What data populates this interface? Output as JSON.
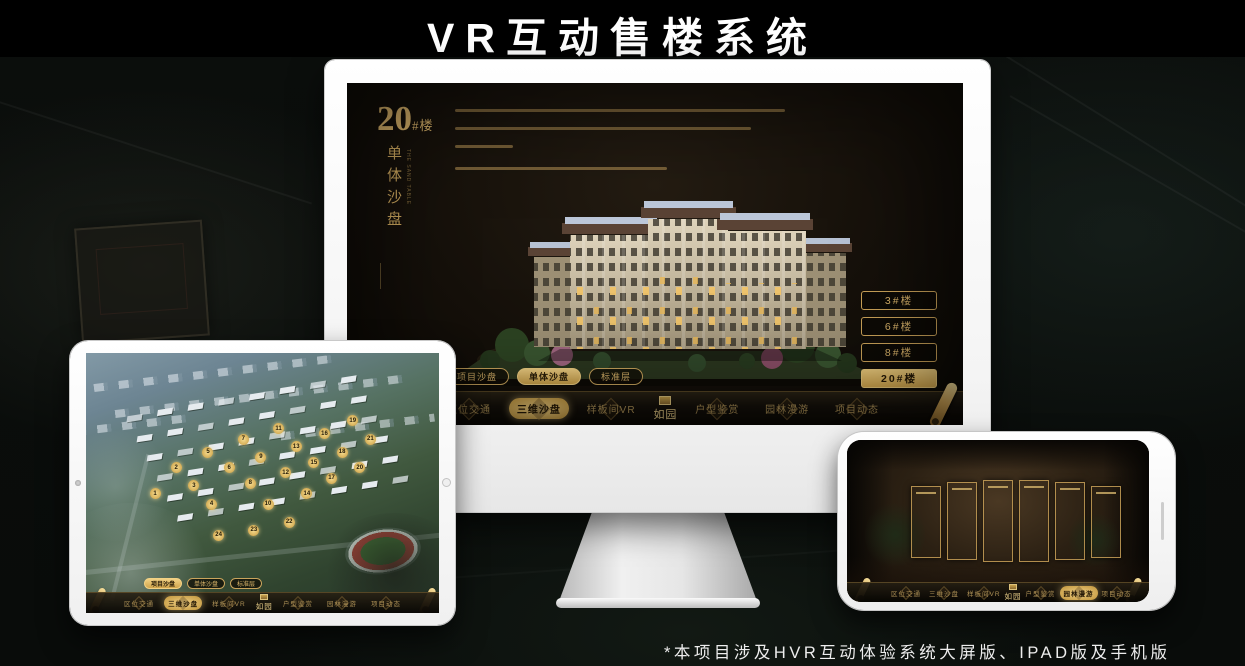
{
  "page": {
    "title": "VR互动售楼系统",
    "footnote": "*本项目涉及HVR互动体验系统大屏版、IPAD版及手机版"
  },
  "colors": {
    "accent_gold": "#d3ac5f",
    "gold_bright": "#f0d084",
    "screen_dark": "#15100a",
    "selected_text": "#241806",
    "title_text": "#ffffff"
  },
  "monitor_app": {
    "unit_label": {
      "number": "20",
      "suffix": "#楼",
      "subtitle": "单体沙盘",
      "subtitle_en": "THE SAND TABLE"
    },
    "unit_buttons": [
      {
        "label": "3#楼",
        "selected": false
      },
      {
        "label": "6#楼",
        "selected": false
      },
      {
        "label": "8#楼",
        "selected": false
      },
      {
        "label": "20#楼",
        "selected": true
      }
    ],
    "view_tabs": [
      {
        "label": "项目沙盘",
        "selected": false
      },
      {
        "label": "单体沙盘",
        "selected": true
      },
      {
        "label": "标准层",
        "selected": false
      }
    ],
    "nav": {
      "logo": "如园",
      "items": [
        {
          "label": "区位交通",
          "selected": false
        },
        {
          "label": "三维沙盘",
          "selected": true
        },
        {
          "label": "样板间VR",
          "selected": false
        },
        {
          "label": "户型鉴赏",
          "selected": false
        },
        {
          "label": "园林漫游",
          "selected": false
        },
        {
          "label": "项目动态",
          "selected": false
        }
      ]
    }
  },
  "tablet_app": {
    "view_tabs": [
      {
        "label": "项目沙盘",
        "selected": true
      },
      {
        "label": "单体沙盘",
        "selected": false
      },
      {
        "label": "标准层",
        "selected": false
      }
    ],
    "nav": {
      "logo": "如园",
      "items": [
        {
          "label": "区位交通",
          "selected": false
        },
        {
          "label": "三维沙盘",
          "selected": true
        },
        {
          "label": "样板间VR",
          "selected": false
        },
        {
          "label": "户型鉴赏",
          "selected": false
        },
        {
          "label": "园林漫游",
          "selected": false
        },
        {
          "label": "项目动态",
          "selected": false
        }
      ]
    },
    "markers": [
      {
        "n": "1",
        "x": 18,
        "y": 52
      },
      {
        "n": "2",
        "x": 24,
        "y": 42
      },
      {
        "n": "3",
        "x": 29,
        "y": 49
      },
      {
        "n": "4",
        "x": 34,
        "y": 56
      },
      {
        "n": "5",
        "x": 33,
        "y": 36
      },
      {
        "n": "6",
        "x": 39,
        "y": 42
      },
      {
        "n": "7",
        "x": 43,
        "y": 31
      },
      {
        "n": "8",
        "x": 45,
        "y": 48
      },
      {
        "n": "9",
        "x": 48,
        "y": 38
      },
      {
        "n": "10",
        "x": 50,
        "y": 56
      },
      {
        "n": "11",
        "x": 53,
        "y": 27
      },
      {
        "n": "12",
        "x": 55,
        "y": 44
      },
      {
        "n": "13",
        "x": 58,
        "y": 34
      },
      {
        "n": "14",
        "x": 61,
        "y": 52
      },
      {
        "n": "15",
        "x": 63,
        "y": 40
      },
      {
        "n": "16",
        "x": 66,
        "y": 29
      },
      {
        "n": "17",
        "x": 68,
        "y": 46
      },
      {
        "n": "18",
        "x": 71,
        "y": 36
      },
      {
        "n": "19",
        "x": 74,
        "y": 24
      },
      {
        "n": "20",
        "x": 76,
        "y": 42
      },
      {
        "n": "21",
        "x": 79,
        "y": 31
      },
      {
        "n": "22",
        "x": 56,
        "y": 63
      },
      {
        "n": "23",
        "x": 46,
        "y": 66
      },
      {
        "n": "24",
        "x": 36,
        "y": 68
      }
    ]
  },
  "phone_app": {
    "nav": {
      "logo": "如园",
      "items": [
        {
          "label": "区位交通",
          "selected": false
        },
        {
          "label": "三维沙盘",
          "selected": false
        },
        {
          "label": "样板间VR",
          "selected": false
        },
        {
          "label": "户型鉴赏",
          "selected": false
        },
        {
          "label": "园林漫游",
          "selected": true
        },
        {
          "label": "项目动态",
          "selected": false
        }
      ]
    }
  }
}
